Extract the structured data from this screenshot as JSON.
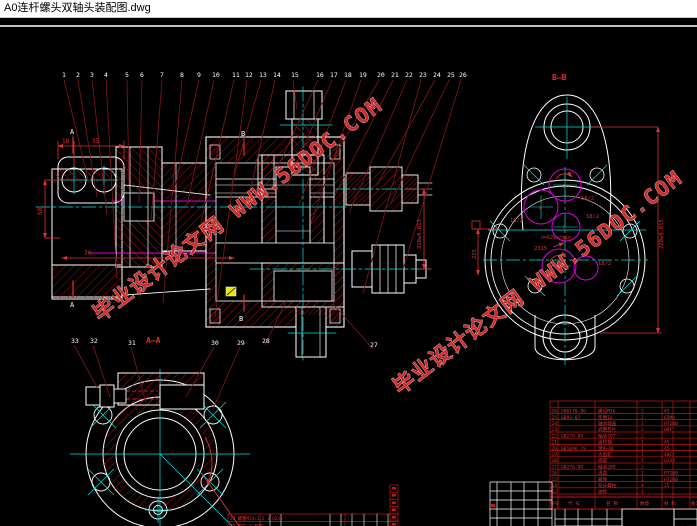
{
  "window": {
    "title": "A0连杆螺头双轴头装配图.dwg"
  },
  "callouts": {
    "top": [
      "1",
      "2",
      "3",
      "4",
      "5",
      "6",
      "7",
      "8",
      "9",
      "10",
      "11",
      "12",
      "13",
      "14",
      "15",
      "16",
      "17",
      "18",
      "19",
      "20",
      "21",
      "22",
      "23",
      "24",
      "25",
      "26"
    ],
    "bottom": [
      "33",
      "32",
      "31",
      "30",
      "29",
      "28",
      "27"
    ]
  },
  "sections": {
    "aa": "A—A",
    "bb": "B—B",
    "a": "A",
    "b": "B"
  },
  "dims": {
    "d18": "18",
    "d35": "35",
    "d58": "58",
    "d70": "70",
    "axis_main": "210±0.015",
    "axis_right": "220±0.015",
    "axis_left": "225",
    "z_label": "2315",
    "speed": "n=629r/min",
    "gear_ratio": "18/2",
    "g1": "2",
    "g2": "4",
    "g3": "0",
    "g4": "1"
  },
  "watermark": {
    "text": "毕业设计论文网 WWW.56DOC.COM"
  },
  "colors": {
    "line": "#ffffff",
    "dimension": "#e03131",
    "hatch": "#b81414",
    "leader": "#8a1616",
    "centerline": "#00e5e5",
    "gear": "#e000e0",
    "highlight": "#e6e600",
    "watermark": "#d42a2a"
  },
  "bom": {
    "header": {
      "no": "序号",
      "code": "代 号",
      "name": "名 称",
      "qty": "数量",
      "mat": "材 料",
      "note": "备注"
    },
    "rows": [
      [
        "26",
        "GB6170-86",
        "螺母M16",
        "2",
        "45"
      ],
      [
        "25",
        "GB93-87",
        "垫圈16",
        "2",
        "65Mn"
      ],
      [
        "24",
        "",
        "轴承端盖",
        "1",
        "HT200"
      ],
      [
        "23",
        "",
        "调整垫片",
        "2",
        "08F"
      ],
      [
        "22",
        "GB276-89",
        "轴承207",
        "2",
        ""
      ],
      [
        "21",
        "",
        "齿轮轴",
        "1",
        "45"
      ],
      [
        "20",
        "GB1096-79",
        "键8×40",
        "1",
        "45"
      ],
      [
        "19",
        "",
        "大齿轮",
        "1",
        "40Cr"
      ],
      [
        "18",
        "",
        "隔套",
        "1",
        "Q235"
      ],
      [
        "17",
        "GB276-89",
        "轴承209",
        "2",
        ""
      ],
      [
        "16",
        "",
        "透盖",
        "1",
        "HT200"
      ],
      [
        "15",
        "",
        "箱体",
        "1",
        "HT200"
      ],
      [
        "14",
        "",
        "双头螺柱",
        "4",
        "35"
      ],
      [
        "13",
        "",
        "油标",
        "1",
        ""
      ]
    ],
    "mini_rows": [
      "33 螺塞M14×1.5  1  Q235",
      "32 垫片        1  石棉",
      "31 轴承盖      1  HT150",
      "30 螺栓M8×20   6  Q235"
    ],
    "title_block": {
      "fields_row": "标记 处数 分区 更改文件号 签名 年月日",
      "sign_row": "设计 校核 审核 工艺 批准",
      "scale_label": "比例 1:1",
      "title_l1": "连杆螺头",
      "title_l2": "装配图"
    }
  }
}
